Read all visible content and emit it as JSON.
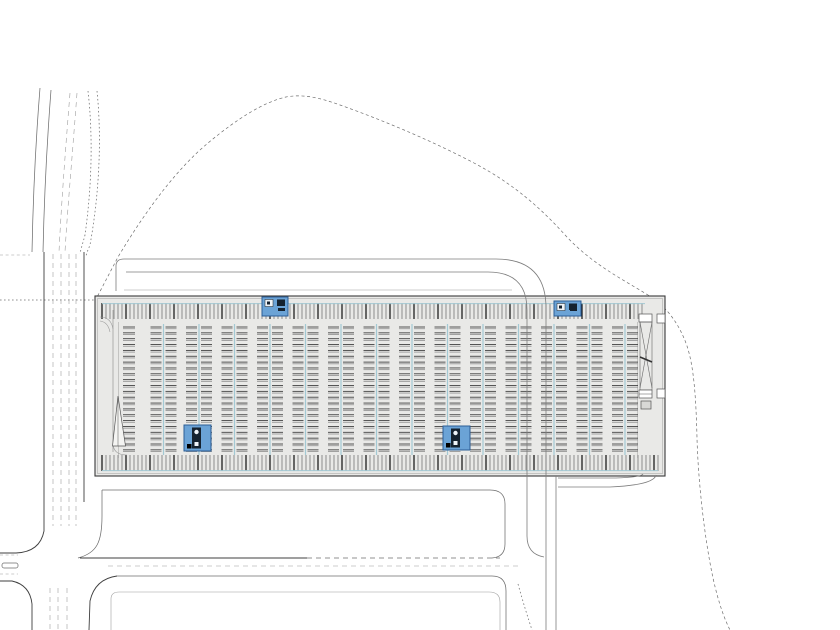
{
  "document": {
    "kind": "architectural-site-plan",
    "description": "parking structure site plan with access roads, site boundary contour and future building plots"
  },
  "palette": {
    "background": "#ffffff",
    "structure_fill": "#e9e9e7",
    "line_dark": "#3a3a3a",
    "line_medium": "#6e6e6e",
    "line_light": "#9e9e9e",
    "teal": "#a3c9d4",
    "stall_dark": "#3a3a3a",
    "stall_gray": "#949494",
    "core_fill": "#6ba3d6",
    "core_border": "#2c5e96",
    "core_glyph_dark": "#15222f",
    "core_glyph_light": "#eef3f8"
  },
  "structure": {
    "x": 95,
    "y": 296,
    "width": 570,
    "height": 180
  },
  "stall_bands": [
    {
      "name": "top-stall-band",
      "x_start": 102,
      "x_end": 645,
      "y_top": 303,
      "y_bottom": 319,
      "spacing": 4,
      "bold_every": 6,
      "curb_y": 303.6
    },
    {
      "name": "bottom-stall-band",
      "x_start": 102,
      "x_end": 658,
      "y_top": 455,
      "y_bottom": 471,
      "spacing": 4,
      "bold_every": 6,
      "curb_y": 470.6
    }
  ],
  "field": {
    "left_separator_x": 118.5,
    "right_separator_x": 637.5,
    "y_top": 322,
    "y_bottom": 458
  },
  "bay_groups": {
    "first_center_x": 163.5,
    "spacing": 35.5,
    "count": 14,
    "line_top": 324,
    "line_bottom": 455,
    "row_start_y": 327,
    "row_spacing": 5.85,
    "row_count": 22,
    "dash_half_gap": 2,
    "dash_length": 11
  },
  "single_row": {
    "center_x": 129,
    "row_start_y": 327,
    "row_spacing": 5.85,
    "row_count": 22,
    "half_width": 6
  },
  "west_ramp": {
    "wall_x": 113,
    "wall_y1": 310,
    "wall_y2": 452,
    "arc1": "M100,317 Q111,317 113,329",
    "arc2": "M100,321 Q108,322 110,332",
    "arc3": "M113,443 Q113,455 127,455",
    "triangle": "M118,396 L112.5,446 L125.5,446 Z",
    "triangle_mid": "M118,398 L118,446"
  },
  "east_ramp": {
    "top_box": [
      639,
      314,
      13,
      8
    ],
    "body": [
      640,
      322,
      12,
      68
    ],
    "cross1": "M640,322 L652,388",
    "cross2": "M652,322 L640,388",
    "mid_bar": "M640,357 L652,362",
    "bottom_box": [
      639,
      390,
      13,
      8
    ],
    "pad": [
      641,
      401,
      10,
      8
    ],
    "outer_boxes": [
      [
        657,
        314,
        8,
        9
      ],
      [
        657,
        389,
        8,
        9
      ]
    ]
  },
  "cores": [
    {
      "id": "north-west-pavilion",
      "x": 262,
      "y": 297,
      "w": 26,
      "h": 19,
      "variant": "pavilion"
    },
    {
      "id": "north-east-pavilion",
      "x": 554,
      "y": 301,
      "w": 27,
      "h": 15,
      "variant": "pavilion"
    },
    {
      "id": "south-west-elevator-core",
      "x": 184,
      "y": 425,
      "w": 27,
      "h": 26,
      "variant": "elevator"
    },
    {
      "id": "south-central-elevator-core",
      "x": 443,
      "y": 426,
      "w": 27,
      "h": 24,
      "variant": "elevator"
    }
  ]
}
